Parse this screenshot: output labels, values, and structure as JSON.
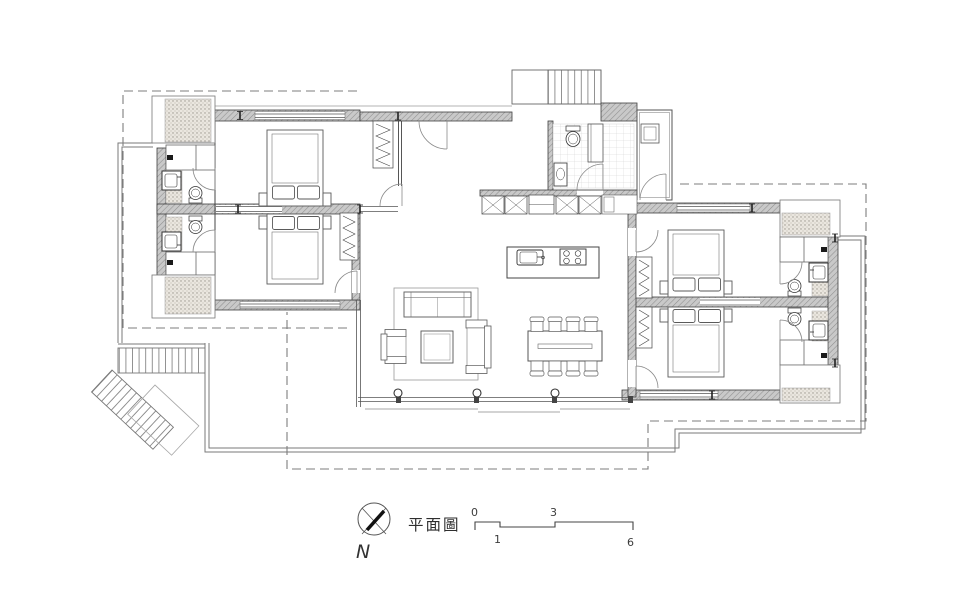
{
  "drawing": {
    "title": "平面圖",
    "compass": {
      "label": "N"
    },
    "scale_bar": {
      "zero": "0",
      "one": "1",
      "three": "3",
      "six": "6"
    },
    "colors": {
      "paper": "#ffffff",
      "wall_fill": "#c8c8c8",
      "hatch_line": "#8f8f8f",
      "line": "#3f3f3f",
      "dashed_boundary": "#7d7d7d",
      "tile": "#cfcfcf",
      "stipple": "#9a958c"
    },
    "depicted_elements": [
      "four bedrooms each with double bed and wardrobe",
      "four en-suite bathrooms with sink and toilet",
      "central guest bathroom with tiled floor",
      "entry stair at top center",
      "exterior L-shaped stair at lower left",
      "kitchen island with sink and four-burner cooktop",
      "dining table with eight chairs",
      "living area with sofa, armchair, loveseat, coffee table and rug",
      "built-in closets marked with X",
      "three columns along south glass wall",
      "surrounding terrace and dashed roof-overhang lines",
      "north arrow and graphic scale"
    ]
  }
}
